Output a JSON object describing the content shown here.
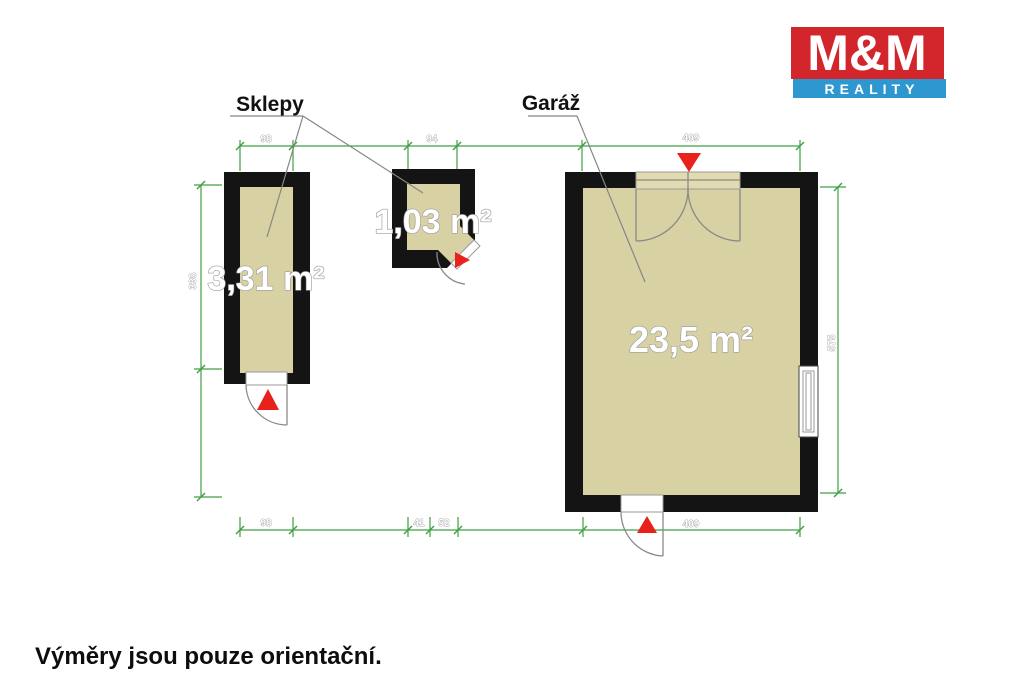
{
  "logo": {
    "name": "M&M",
    "subtitle": "REALITY"
  },
  "room_labels": {
    "cellars": "Sklepy",
    "garage": "Garáž"
  },
  "areas": {
    "cellar_long": "3,31 m²",
    "cellar_small": "1,03 m²",
    "garage": "23,5 m²"
  },
  "dimensions": {
    "cellar_long_width_top": "98",
    "cellar_small_width_top": "94",
    "garage_width_top": "409",
    "cellar_long_height": "338",
    "garage_height": "575",
    "cellar_long_width_bottom": "98",
    "door_segment_1": "41",
    "door_segment_2": "52",
    "garage_width_bottom": "409"
  },
  "note": "Výměry jsou pouze orientační.",
  "colors": {
    "wall": "#141414",
    "floor": "#d8d1a4",
    "dimension_green": "#3fa044",
    "accent_red": "#e8211a",
    "logo_red": "#d2262c",
    "logo_blue": "#2f97cf"
  }
}
